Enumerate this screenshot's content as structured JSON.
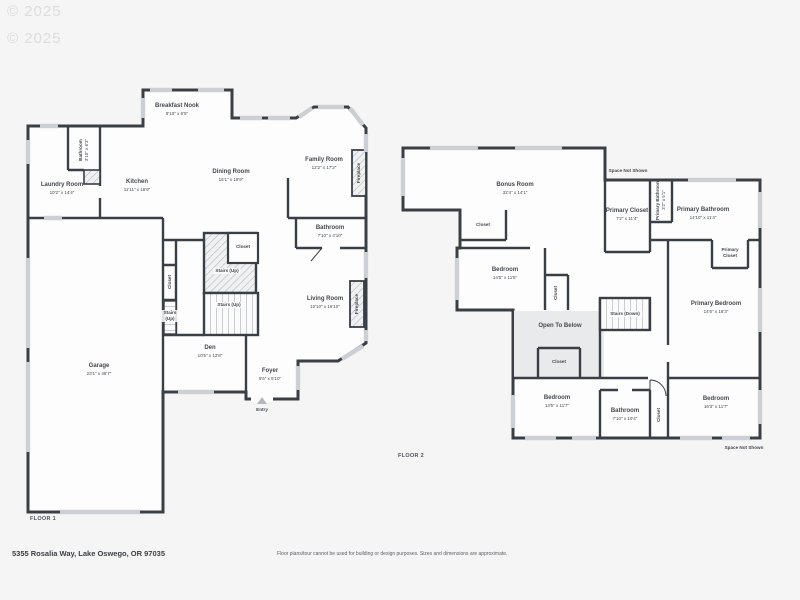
{
  "watermark": {
    "line1": "© 2025",
    "line2": "© 2025"
  },
  "footer": {
    "address": "5355 Rosalia Way, Lake Oswego, OR 97035",
    "disclaimer": "Floor plans/tour cannot be used for building or design purposes. Sizes and dimensions are approximate."
  },
  "colors": {
    "wall": "#3a3f45",
    "window": "#ccd0d4",
    "shade": "#e9eaec",
    "text": "#44484e"
  },
  "floor1": {
    "title": "FLOOR 1",
    "rooms": {
      "breakfast_nook": {
        "name": "Breakfast Nook",
        "dims": "8'10\" x 6'9\""
      },
      "bathroom_small": {
        "name": "Bathroom",
        "dims": "3'10\" x 6'3\""
      },
      "laundry": {
        "name": "Laundry Room",
        "dims": "10'2\" x 14'4\""
      },
      "kitchen": {
        "name": "Kitchen",
        "dims": "11'11\" x 16'9\""
      },
      "dining": {
        "name": "Dining Room",
        "dims": "16'1\" x 18'9\""
      },
      "family": {
        "name": "Family Room",
        "dims": "12'2\" x 17'2\""
      },
      "fireplace_family": {
        "name": "Fireplace"
      },
      "bathroom": {
        "name": "Bathroom",
        "dims": "7'10\" x 4'10\""
      },
      "closet_stairs": {
        "name": "Closet"
      },
      "stairs_up_a": {
        "name": "Stairs (Up)"
      },
      "stairs_up_b": {
        "name": "Stairs (Up)"
      },
      "closet_left": {
        "name": "Closet"
      },
      "stairs_up_left": {
        "name": "Stairs (Up)"
      },
      "living": {
        "name": "Living Room",
        "dims": "10'10\" x 16'10\""
      },
      "fireplace_living": {
        "name": "Fireplace"
      },
      "den": {
        "name": "Den",
        "dims": "10'6\" x 12'8\""
      },
      "foyer": {
        "name": "Foyer",
        "dims": "6'6\" x 5'10\""
      },
      "entry": {
        "name": "Entry"
      },
      "garage": {
        "name": "Garage",
        "dims": "23'1\" x 46'7\""
      }
    }
  },
  "floor2": {
    "title": "FLOOR 2",
    "rooms": {
      "bonus": {
        "name": "Bonus Room",
        "dims": "32'4\" x 14'1\""
      },
      "space_not_shown_top": {
        "name": "Space Not Shown"
      },
      "primary_closet": {
        "name": "Primary Closet",
        "dims": "7'2\" x 11'4\""
      },
      "primary_bathroom_small": {
        "name": "Primary Bathroom",
        "dims": "3'2\" x 5'1\""
      },
      "primary_bathroom": {
        "name": "Primary Bathroom",
        "dims": "14'10\" x 11'4\""
      },
      "primary_closet_small": {
        "name": "Primary Closet"
      },
      "closet_bonus": {
        "name": "Closet"
      },
      "bedroom_mid": {
        "name": "Bedroom",
        "dims": "14'5\" x 11'5\""
      },
      "closet_mid": {
        "name": "Closet"
      },
      "open_below": {
        "name": "Open To Below"
      },
      "stairs_down": {
        "name": "Stairs (Down)"
      },
      "primary_bedroom": {
        "name": "Primary Bedroom",
        "dims": "14'6\" x 18'3\""
      },
      "closet_open": {
        "name": "Closet"
      },
      "bedroom_bl": {
        "name": "Bedroom",
        "dims": "13'5\" x 11'7\""
      },
      "bathroom2": {
        "name": "Bathroom",
        "dims": "7'10\" x 10'4\""
      },
      "closet_bottom": {
        "name": "Closet"
      },
      "bedroom_br": {
        "name": "Bedroom",
        "dims": "16'3\" x 11'7\""
      },
      "space_not_shown_bottom": {
        "name": "Space Not Shown"
      }
    }
  }
}
